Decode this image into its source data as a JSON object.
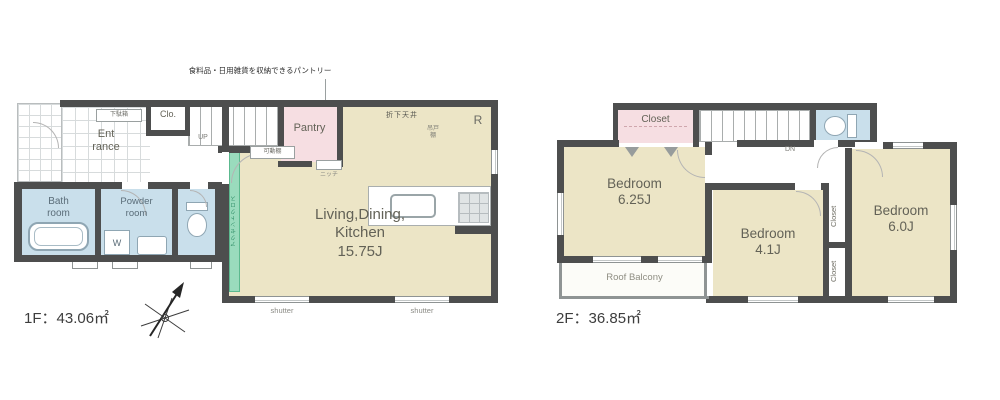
{
  "floor1": {
    "area_label": "1F：43.06㎡",
    "pantry_note": "食料品・日用雑貨を収納できるパントリー",
    "rooms": {
      "entrance": "Ent\nrance",
      "closet": "Clo.",
      "pantry": "Pantry",
      "ldk": "Living,Dining,\nKitchen\n15.75J",
      "bath": "Bath\nroom",
      "powder": "Powder\nroom"
    },
    "labels": {
      "shoe_cabinet": "下駄箱",
      "up": "UP",
      "movable_shelf": "可動棚",
      "niche": "ニッチ",
      "dropped_ceiling": "折下天井",
      "refrigerator": "R",
      "hanging_cabinet": "吊戸\n棚",
      "washer": "W",
      "accent_wall": "アクセントクロス",
      "shutter_left": "shutter",
      "shutter_right": "shutter"
    }
  },
  "floor2": {
    "area_label": "2F：36.85㎡",
    "rooms": {
      "closet_hall": "Closet",
      "bedroom_a": "Bedroom\n6.25J",
      "bedroom_b": "Bedroom\n4.1J",
      "bedroom_c": "Bedroom\n6.0J",
      "roof_balcony": "Roof Balcony",
      "closet_b1": "Closet",
      "closet_b2": "Closet"
    },
    "labels": {
      "down": "DN"
    }
  },
  "colors": {
    "wall": "#4d4e4e",
    "room_cream": "#ece5c6",
    "room_pink": "#f6dee2",
    "room_blue": "#c9dfeb",
    "accent_green": "#9adbbd"
  }
}
